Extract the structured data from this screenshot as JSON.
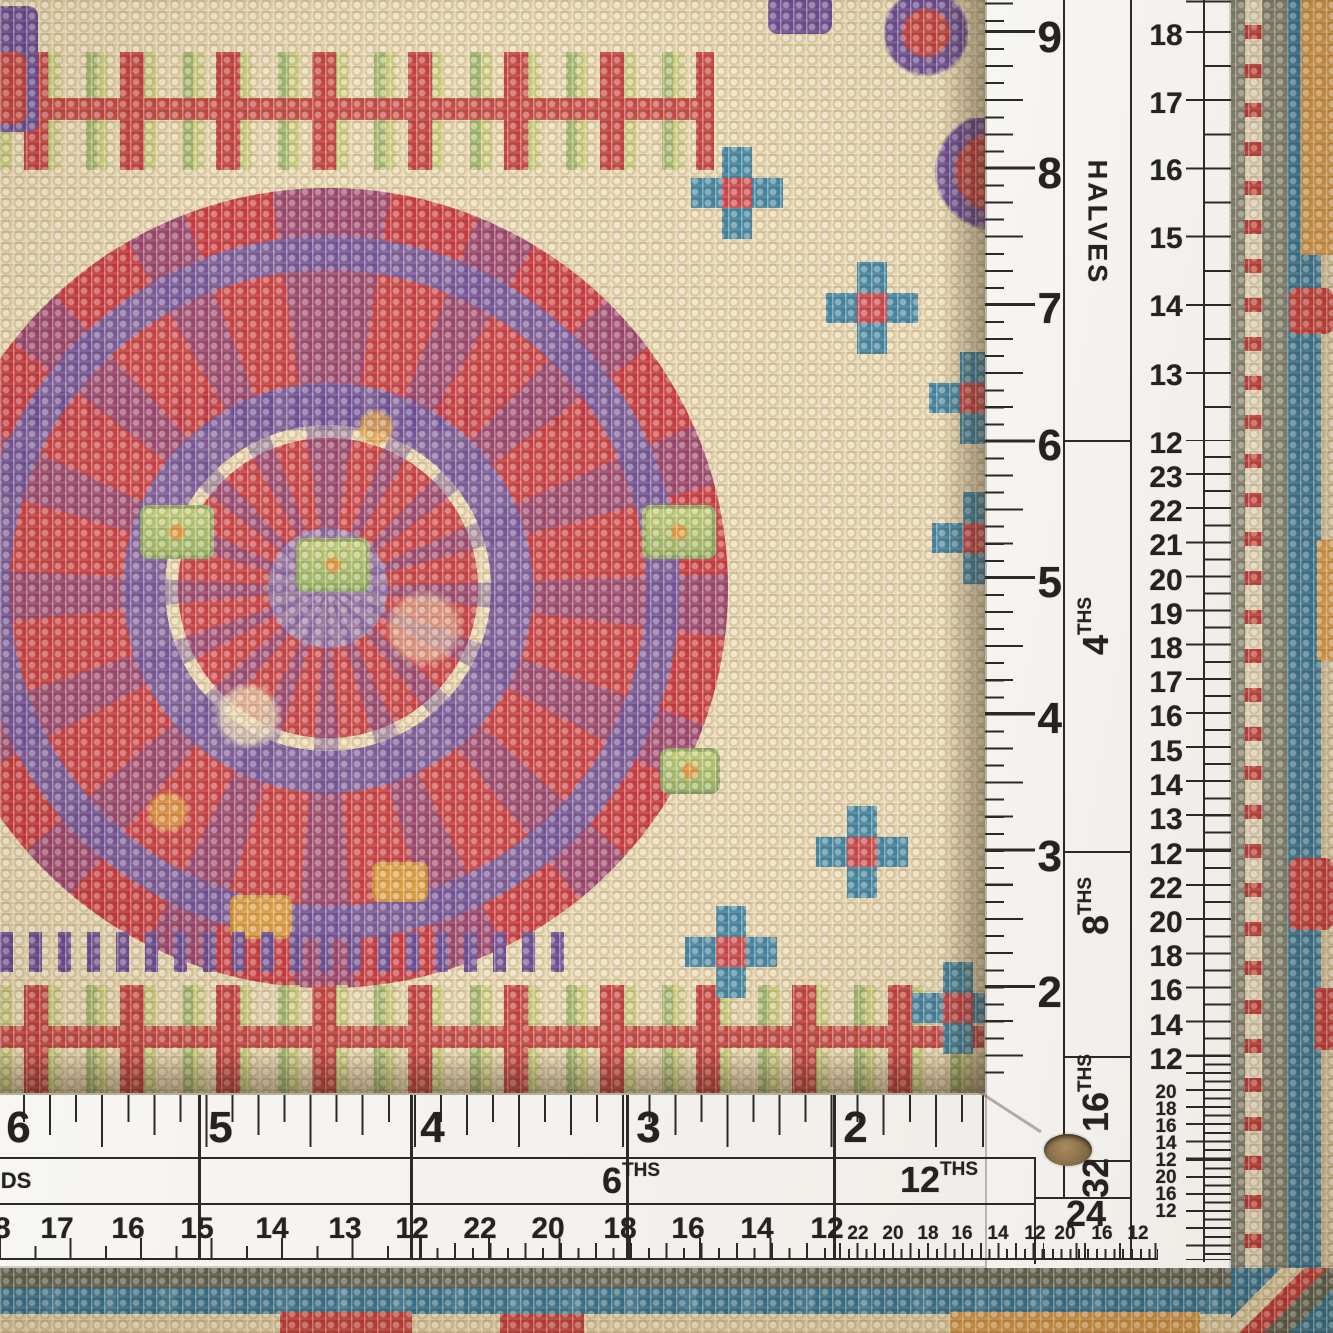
{
  "scene": {
    "kind": "photograph",
    "subject": "hand-knotted wool rug corner measured by an L-shaped white ruler"
  },
  "colors": {
    "ruler_white": "#f4f2ef",
    "ruler_ink": "#2b2a26",
    "rug_cream": "#e8d6ac",
    "rug_red": "#c22f2e",
    "rug_purple": "#5d3b8f",
    "rug_orange": "#e09a36",
    "rug_green": "#8fae58",
    "rug_yellow_green": "#c9cc72",
    "rug_teal": "#276f92",
    "rug_grey_green": "#7c7f6d",
    "grommet_brown": "#8d7350"
  },
  "rulers": {
    "vertical": {
      "inches": [
        [
          "9",
          32
        ],
        [
          "8",
          168
        ],
        [
          "7",
          303
        ],
        [
          "6",
          440
        ],
        [
          "5",
          577
        ],
        [
          "4",
          713
        ],
        [
          "3",
          851
        ],
        [
          "2",
          987
        ]
      ],
      "sections": [
        {
          "text": "HALVES",
          "sup": "",
          "y": 222,
          "rot": "cw",
          "word": true
        },
        {
          "text": "4",
          "sup": "THS",
          "y": 645,
          "rot": "ccw",
          "word": false
        },
        {
          "text": "8",
          "sup": "THS",
          "y": 925,
          "rot": "ccw",
          "word": false
        },
        {
          "text": "16",
          "sup": "THS",
          "y": 1112,
          "rot": "ccw",
          "word": false
        },
        {
          "text": "32",
          "sup": "",
          "y": 1178,
          "rot": "ccw",
          "word": false
        }
      ],
      "subs_md": [
        [
          "18",
          32
        ],
        [
          "17",
          100
        ],
        [
          "16",
          167
        ],
        [
          "15",
          235
        ],
        [
          "14",
          303
        ],
        [
          "13",
          372
        ],
        [
          "12",
          440
        ],
        [
          "23",
          474
        ],
        [
          "22",
          508
        ],
        [
          "21",
          542
        ],
        [
          "20",
          577
        ],
        [
          "19",
          611
        ],
        [
          "18",
          645
        ],
        [
          "17",
          679
        ],
        [
          "16",
          713
        ],
        [
          "15",
          748
        ],
        [
          "14",
          782
        ],
        [
          "13",
          816
        ],
        [
          "12",
          851
        ],
        [
          "22",
          885
        ],
        [
          "20",
          919
        ],
        [
          "18",
          953
        ],
        [
          "16",
          987
        ],
        [
          "14",
          1022
        ],
        [
          "12",
          1056
        ]
      ],
      "subs_sm": [
        [
          "20",
          1090
        ],
        [
          "18",
          1107
        ],
        [
          "16",
          1124
        ],
        [
          "14",
          1141
        ],
        [
          "12",
          1158
        ],
        [
          "20",
          1175
        ],
        [
          "16",
          1192
        ],
        [
          "12",
          1209
        ]
      ]
    },
    "horizontal": {
      "inches": [
        [
          "6",
          18
        ],
        [
          "5",
          220
        ],
        [
          "4",
          432
        ],
        [
          "3",
          648
        ],
        [
          "2",
          855
        ]
      ],
      "labels": [
        {
          "text": "DS",
          "sup": "",
          "x": 16,
          "y": 1181,
          "small": true
        },
        {
          "text": "6",
          "sup": "THS",
          "x": 612,
          "y": 1181,
          "small": false
        },
        {
          "text": "12",
          "sup": "THS",
          "x": 920,
          "y": 1180,
          "small": false
        },
        {
          "text": "24",
          "sup": "",
          "x": 1086,
          "y": 1214,
          "small": false
        }
      ],
      "subs_md": [
        [
          "18",
          -6
        ],
        [
          "17",
          57
        ],
        [
          "16",
          128
        ],
        [
          "15",
          197
        ],
        [
          "14",
          272
        ],
        [
          "13",
          345
        ],
        [
          "12",
          412
        ],
        [
          "22",
          480
        ],
        [
          "20",
          548
        ],
        [
          "18",
          620
        ],
        [
          "16",
          688
        ],
        [
          "14",
          757
        ],
        [
          "12",
          827
        ]
      ],
      "subs_sm": [
        [
          "22",
          858
        ],
        [
          "20",
          893
        ],
        [
          "18",
          928
        ],
        [
          "16",
          962
        ],
        [
          "14",
          998
        ],
        [
          "12",
          1035
        ],
        [
          "20",
          1065
        ],
        [
          "16",
          1102
        ],
        [
          "12",
          1138
        ]
      ]
    }
  }
}
